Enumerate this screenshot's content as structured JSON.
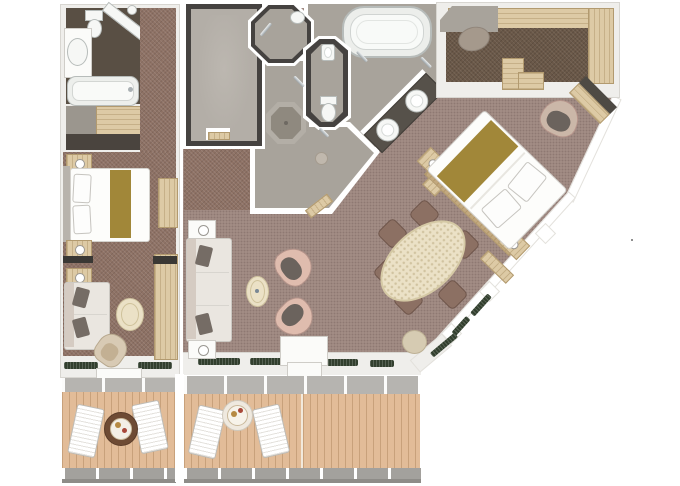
{
  "title": "suite-floor-plan",
  "colors": {
    "canvas": "#ffffff",
    "wall": "#efeeeb",
    "wall-edge": "#d8d6d1",
    "dark-wall": "#454240",
    "carpet-main": "#a28c85",
    "carpet-corridor": "#8e7265",
    "carpet-closet": "#6a5848",
    "floor-gray": "#a8a39b",
    "floor-gray2": "#b3aea7",
    "bath-dark": "#594f44",
    "fixture": "#f6f7f5",
    "rim": "#b7bcba",
    "wood": "#ddcaa5",
    "wood-dark": "#c2a87e",
    "counter": "#56514a",
    "deck": "#e2bc98",
    "deck-line": "#c8a17b",
    "rail": "#a3a19d",
    "gold": "#a18739",
    "sofa": "#d5cbc2",
    "cushion": "#756c65",
    "pink": "#dfbcae",
    "seat": "#6b635d",
    "cream": "#ebe1c6",
    "dining-chair": "#8c7063",
    "plant": "#323f2e",
    "chrome": "#ccd1d3"
  },
  "inventory": {
    "plan": "suite floor plan",
    "left_stateroom": "adjoining stateroom",
    "left_bathroom": "stateroom bathroom",
    "left_bed": "stateroom queen bed",
    "left_sofa": "stateroom sofa",
    "left_balcony": "stateroom balcony",
    "foyer": "entry foyer",
    "shower_room": "shower room",
    "wc": "toilet room",
    "dressing_room": "dressing room",
    "bathroom": "master bathroom",
    "bathtub": "oval bathtub",
    "vanity": "double vanity",
    "closet": "walk-in closet",
    "bedroom_bed": "master bed",
    "armchair": "armchair",
    "desk": "dressing desk",
    "dining_table": "oval dining table",
    "living_sofa": "living room sofa",
    "coffee_table": "coffee table",
    "balcony": "main balcony",
    "lounger": "deck lounger",
    "deck_table": "deck table"
  }
}
